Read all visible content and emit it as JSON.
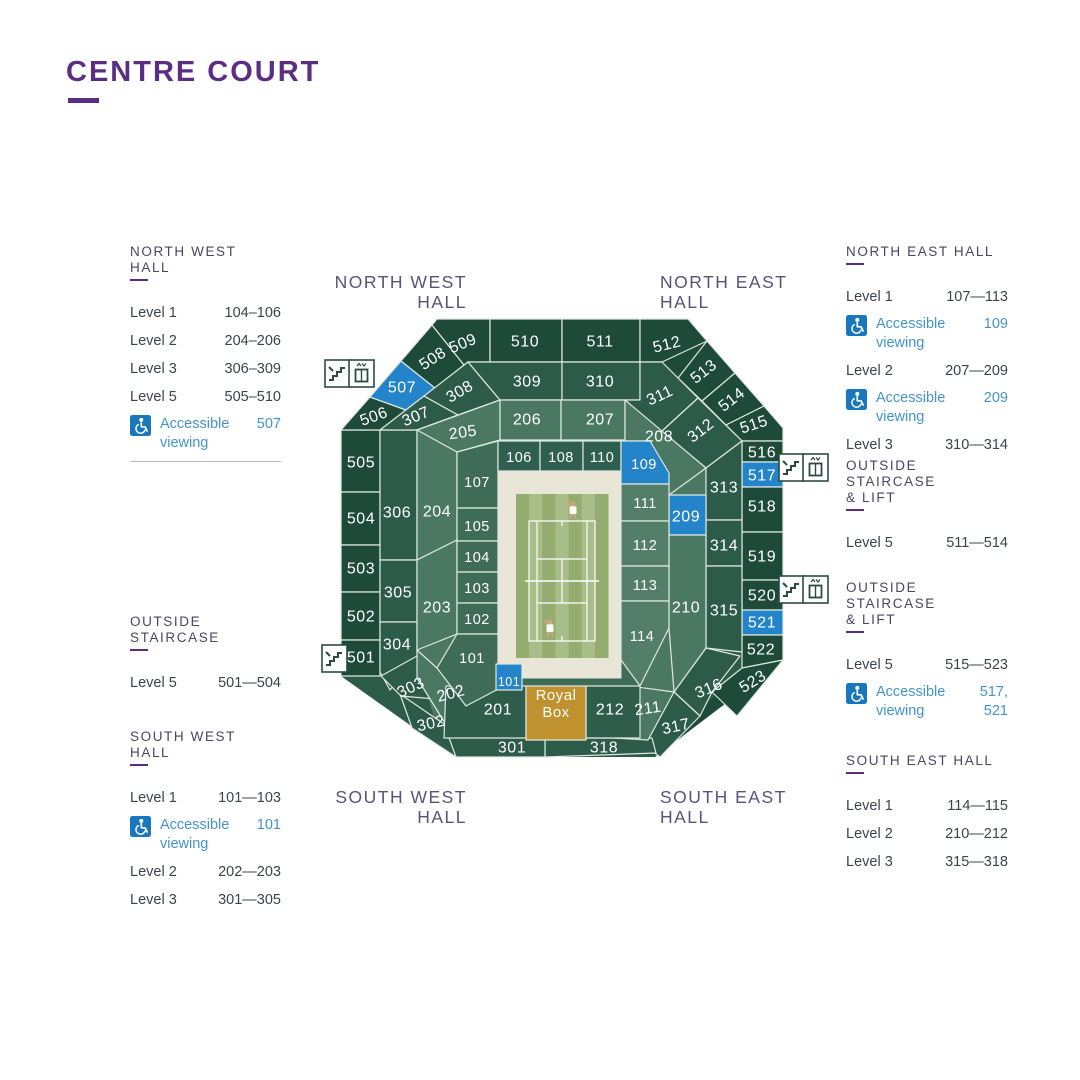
{
  "title": {
    "text": "CENTRE COURT"
  },
  "hall_labels": [
    {
      "text": "NORTH WEST\nHALL",
      "x": 267,
      "y": 273,
      "align": "right",
      "w": 200
    },
    {
      "text": "NORTH EAST\nHALL",
      "x": 660,
      "y": 273,
      "align": "left",
      "w": 200
    },
    {
      "text": "SOUTH WEST\nHALL",
      "x": 267,
      "y": 788,
      "align": "right",
      "w": 200
    },
    {
      "text": "SOUTH EAST\nHALL",
      "x": 660,
      "y": 788,
      "align": "left",
      "w": 200
    }
  ],
  "legend_left": [
    {
      "top": 244,
      "left": 130,
      "w": 151,
      "header": "NORTH WEST HALL",
      "divider": true,
      "rows": [
        {
          "label": "Level 1",
          "value": "104–106"
        },
        {
          "label": "Level 2",
          "value": "204–206"
        },
        {
          "label": "Level 3",
          "value": "306–309"
        },
        {
          "label": "Level 5",
          "value": "505–510"
        },
        {
          "label": "Accessible viewing",
          "value": "507",
          "accessible": true
        }
      ]
    },
    {
      "top": 614,
      "left": 130,
      "w": 151,
      "header": "OUTSIDE STAIRCASE",
      "rows": [
        {
          "label": "Level 5",
          "value": "501—504"
        }
      ]
    },
    {
      "top": 729,
      "left": 130,
      "w": 151,
      "header": "SOUTH WEST HALL",
      "rows": [
        {
          "label": "Level 1",
          "value": "101—103"
        },
        {
          "label": "Accessible viewing",
          "value": "101",
          "accessible": true
        },
        {
          "label": "Level 2",
          "value": "202—203"
        },
        {
          "label": "Level 3",
          "value": "301—305"
        }
      ]
    }
  ],
  "legend_right": [
    {
      "top": 244,
      "left": 846,
      "w": 162,
      "header": "NORTH EAST HALL",
      "rows": [
        {
          "label": "Level 1",
          "value": "107—113"
        },
        {
          "label": "Accessible viewing",
          "value": "109",
          "accessible": true
        },
        {
          "label": "Level 2",
          "value": "207—209"
        },
        {
          "label": "Accessible viewing",
          "value": "209",
          "accessible": true
        },
        {
          "label": "Level 3",
          "value": "310—314"
        }
      ]
    },
    {
      "top": 458,
      "left": 846,
      "w": 162,
      "header": "OUTSIDE STAIRCASE\n& LIFT",
      "rows": [
        {
          "label": "Level 5",
          "value": "511—514"
        }
      ]
    },
    {
      "top": 580,
      "left": 846,
      "w": 162,
      "header": "OUTSIDE STAIRCASE\n& LIFT",
      "rows": [
        {
          "label": "Level 5",
          "value": "515—523"
        },
        {
          "label": "Accessible viewing",
          "value": "517, 521",
          "accessible": true
        }
      ]
    },
    {
      "top": 753,
      "left": 846,
      "w": 162,
      "header": "SOUTH EAST HALL",
      "rows": [
        {
          "label": "Level 1",
          "value": "114—115"
        },
        {
          "label": "Level 2",
          "value": "210—212"
        },
        {
          "label": "Level 3",
          "value": "315—318"
        }
      ]
    }
  ],
  "map": {
    "colors": {
      "r5": "#1d4a39",
      "r3": "#2d5b49",
      "r2": "#4a7862",
      "r2d": "#2f5d4b",
      "r1w": "#3f6c59",
      "r1n": "#2e5f4f",
      "r1e": "#527e6a",
      "blue": "#2384ca",
      "gold": "#c0912f",
      "beige": "#e9e5d7",
      "grass1": "#93ad70",
      "grass2": "#a9bd89",
      "stroke": "#dfe8df",
      "icon": "#2b4d40",
      "legend_blue_icon": "#1877bd"
    },
    "silhouettes": [
      {
        "p": "437,319 688,319 783,428 783,660 655,757 455,757 341,676 341,430",
        "f": "r5"
      },
      {
        "p": "468,362 662,362 742,441 742,668 655,757 455,757 341,676 380,676 380,430",
        "f": "r3"
      },
      {
        "p": "500,400 625,400 706,468 706,648 645,738 440,738 417,660 417,430",
        "f": "r2"
      },
      {
        "p": "440,686 645,686 645,738 440,738",
        "f": "r2d"
      },
      {
        "p": "498,441 650,441 669,473 669,628 640,686 496,686 437,668 457,634 457,452",
        "f": "r1w"
      }
    ],
    "sections": [
      {
        "l": "505",
        "p": "341,430 380,430 380,492 341,492",
        "f": "r5",
        "x": 361,
        "y": 463
      },
      {
        "l": "504",
        "p": "341,492 380,492 380,545 341,545",
        "f": "r5",
        "x": 361,
        "y": 519
      },
      {
        "l": "503",
        "p": "341,545 380,545 380,592 341,592",
        "f": "r5",
        "x": 361,
        "y": 569
      },
      {
        "l": "502",
        "p": "341,592 380,592 380,640 341,640",
        "f": "r5",
        "x": 361,
        "y": 617
      },
      {
        "l": "501",
        "p": "341,640 380,640 380,676 341,676",
        "f": "r5",
        "x": 361,
        "y": 658
      },
      {
        "l": "506",
        "p": "341,430 370,397 406,410 380,430",
        "f": "r5",
        "x": 374,
        "y": 417,
        "r": -20
      },
      {
        "l": "507",
        "p": "370,397 401,361 435,388 406,410",
        "f": "blue",
        "x": 402,
        "y": 388
      },
      {
        "l": "508",
        "p": "401,361 432,325 464,365 435,388",
        "f": "r5",
        "x": 433,
        "y": 359,
        "r": -33
      },
      {
        "l": "509",
        "p": "432,325 437,319 490,319 490,362 468,362 464,365",
        "f": "r5",
        "x": 463,
        "y": 344,
        "r": -22
      },
      {
        "l": "510",
        "p": "490,319 562,319 562,362 490,362",
        "f": "r5",
        "x": 525,
        "y": 342
      },
      {
        "l": "511",
        "p": "562,319 640,319 640,362 562,362",
        "f": "r5",
        "x": 600,
        "y": 342
      },
      {
        "l": "512",
        "p": "640,319 688,319 707,341 662,362 640,362",
        "f": "r5",
        "x": 667,
        "y": 345,
        "r": -14
      },
      {
        "l": "513",
        "p": "707,341 735,373 702,401 678,378",
        "f": "r5",
        "x": 704,
        "y": 372,
        "r": -38
      },
      {
        "l": "514",
        "p": "735,373 764,406 726,425 702,401",
        "f": "r5",
        "x": 732,
        "y": 400,
        "r": -38
      },
      {
        "l": "515",
        "p": "764,406 783,428 783,441 742,441 726,425",
        "f": "r5",
        "x": 754,
        "y": 425,
        "r": -18
      },
      {
        "l": "516",
        "p": "742,441 783,441 783,462 742,462",
        "f": "r5",
        "x": 762,
        "y": 453
      },
      {
        "l": "517",
        "p": "742,462 783,462 783,487 742,487",
        "f": "blue",
        "x": 762,
        "y": 476
      },
      {
        "l": "518",
        "p": "742,487 783,487 783,532 742,532",
        "f": "r5",
        "x": 762,
        "y": 507
      },
      {
        "l": "519",
        "p": "742,532 783,532 783,580 742,580",
        "f": "r5",
        "x": 762,
        "y": 557
      },
      {
        "l": "520",
        "p": "742,580 783,580 783,610 742,610",
        "f": "r5",
        "x": 762,
        "y": 596
      },
      {
        "l": "521",
        "p": "742,610 783,610 783,635 742,635",
        "f": "blue",
        "x": 762,
        "y": 623
      },
      {
        "l": "522",
        "p": "742,635 783,635 783,660 742,668",
        "f": "r5",
        "x": 761,
        "y": 650
      },
      {
        "l": "523",
        "p": "742,668 783,660 737,716 712,692",
        "f": "r5",
        "x": 753,
        "y": 682,
        "r": -32
      },
      {
        "l": "306",
        "p": "380,430 417,430 417,560 380,560",
        "f": "r3",
        "x": 397,
        "y": 513
      },
      {
        "l": "305",
        "p": "380,560 417,560 417,622 380,622",
        "f": "r3",
        "x": 398,
        "y": 593
      },
      {
        "l": "304",
        "p": "380,622 417,622 417,658 390,690 380,672",
        "f": "r3",
        "x": 397,
        "y": 645
      },
      {
        "l": "307",
        "p": "380,430 424,396 458,415 417,430",
        "f": "r3",
        "x": 416,
        "y": 417,
        "r": -22
      },
      {
        "l": "308",
        "p": "424,396 468,362 500,400 458,415",
        "f": "r3",
        "x": 460,
        "y": 392,
        "r": -30
      },
      {
        "l": "309",
        "p": "468,362 562,362 562,400 500,400",
        "f": "r3",
        "x": 527,
        "y": 382
      },
      {
        "l": "310",
        "p": "562,362 640,362 640,400 562,400",
        "f": "r3",
        "x": 600,
        "y": 382
      },
      {
        "l": "311",
        "p": "640,362 662,362 698,398 661,432 625,400 640,400",
        "f": "r3",
        "x": 660,
        "y": 396,
        "r": -25
      },
      {
        "l": "312",
        "p": "698,398 742,441 706,468 661,432",
        "f": "r3",
        "x": 701,
        "y": 431,
        "r": -38
      },
      {
        "l": "313",
        "p": "706,468 742,441 742,520 706,520",
        "f": "r3",
        "x": 724,
        "y": 488
      },
      {
        "l": "314",
        "p": "706,520 742,520 742,566 706,566",
        "f": "r3",
        "x": 724,
        "y": 546
      },
      {
        "l": "315",
        "p": "706,566 742,566 742,652 706,648",
        "f": "r3",
        "x": 724,
        "y": 611
      },
      {
        "l": "316",
        "p": "706,648 740,656 712,692 700,716 674,692",
        "f": "r3",
        "x": 709,
        "y": 689,
        "r": -22
      },
      {
        "l": "317",
        "p": "674,692 700,716 660,757 634,737",
        "f": "r3",
        "x": 676,
        "y": 727,
        "r": -12
      },
      {
        "l": "318",
        "p": "545,738 652,738 656,753 545,757",
        "f": "r3",
        "x": 604,
        "y": 748
      },
      {
        "l": "301",
        "p": "444,728 545,738 545,757 456,757",
        "f": "r3",
        "x": 512,
        "y": 748
      },
      {
        "l": "302",
        "p": "400,694 444,724 456,757 412,728",
        "f": "r3",
        "x": 431,
        "y": 724,
        "r": -12
      },
      {
        "l": "303",
        "p": "381,676 417,656 446,700 401,696",
        "f": "r3",
        "x": 411,
        "y": 688,
        "r": -25
      },
      {
        "l": "204",
        "p": "417,430 457,444 457,540 417,560",
        "f": "r2",
        "x": 437,
        "y": 512
      },
      {
        "l": "203",
        "p": "417,560 457,540 457,634 417,650",
        "f": "r2",
        "x": 437,
        "y": 608
      },
      {
        "l": "202",
        "p": "417,650 437,668 470,700 448,728 417,678",
        "f": "r2",
        "x": 451,
        "y": 694,
        "r": -15
      },
      {
        "l": "205",
        "p": "417,430 500,400 500,440 457,452",
        "f": "r2",
        "x": 463,
        "y": 433,
        "r": -8
      },
      {
        "l": "206",
        "p": "500,400 561,400 561,440 500,440",
        "f": "r2",
        "x": 527,
        "y": 420
      },
      {
        "l": "207",
        "p": "561,400 625,400 625,440 561,440",
        "f": "r2",
        "x": 600,
        "y": 420
      },
      {
        "l": "208",
        "p": "625,400 706,468 669,495 650,441 625,441",
        "f": "r2",
        "x": 659,
        "y": 437
      },
      {
        "l": "209",
        "p": "669,495 706,495 706,535 669,535",
        "f": "blue",
        "x": 686,
        "y": 517
      },
      {
        "l": "210",
        "p": "669,535 706,535 706,648 674,692 669,628",
        "f": "r2",
        "x": 686,
        "y": 608
      },
      {
        "l": "211",
        "p": "630,686 674,692 648,740 614,738",
        "f": "r2",
        "x": 648,
        "y": 709,
        "r": -8
      },
      {
        "l": "212",
        "p": "586,686 640,686 640,738 586,738",
        "f": "r2d",
        "x": 610,
        "y": 710
      },
      {
        "l": "201",
        "p": "446,686 526,686 526,738 444,738",
        "f": "r2d",
        "x": 498,
        "y": 710
      },
      {
        "l": "Royal",
        "l2": "Box",
        "p": "526,686 586,686 586,740 526,740",
        "f": "gold",
        "x": 556,
        "y": 703,
        "s": 15
      },
      {
        "l": "107",
        "p": "457,452 498,441 498,508 457,508",
        "f": "r1w",
        "x": 477,
        "y": 483,
        "s": 14.5
      },
      {
        "l": "105",
        "p": "457,508 498,508 498,541 457,541",
        "f": "r1w",
        "x": 477,
        "y": 527,
        "s": 14.5
      },
      {
        "l": "104",
        "p": "457,541 498,541 498,572 457,572",
        "f": "r1w",
        "x": 477,
        "y": 558,
        "s": 14.5
      },
      {
        "l": "103",
        "p": "457,572 498,572 498,603 457,603",
        "f": "r1w",
        "x": 477,
        "y": 589,
        "s": 14.5
      },
      {
        "l": "102",
        "p": "457,603 498,603 498,634 457,634",
        "f": "r1w",
        "x": 477,
        "y": 620,
        "s": 14.5
      },
      {
        "l": "101",
        "p": "457,634 498,634 498,680 504,686 466,706 437,668",
        "f": "r1w",
        "x": 472,
        "y": 659,
        "s": 14.5
      },
      {
        "l": "106",
        "p": "498,441 540,441 540,471 498,471",
        "f": "r1n",
        "x": 519,
        "y": 458,
        "s": 14.5
      },
      {
        "l": "108",
        "p": "540,441 583,441 583,471 540,471",
        "f": "r1n",
        "x": 561,
        "y": 458,
        "s": 14.5
      },
      {
        "l": "110",
        "p": "583,441 621,441 621,471 583,471",
        "f": "r1n",
        "x": 602,
        "y": 458,
        "s": 14.5
      },
      {
        "l": "109",
        "p": "621,441 650,441 669,473 669,484 621,484",
        "f": "blue",
        "x": 644,
        "y": 465,
        "s": 14.5
      },
      {
        "l": "111",
        "p": "621,484 669,484 669,521 621,521",
        "f": "r1e",
        "x": 645,
        "y": 504,
        "s": 14.5
      },
      {
        "l": "112",
        "p": "621,521 669,521 669,566 621,566",
        "f": "r1e",
        "x": 645,
        "y": 546,
        "s": 14.5
      },
      {
        "l": "113",
        "p": "621,566 669,566 669,601 621,601",
        "f": "r1e",
        "x": 645,
        "y": 586,
        "s": 14.5
      },
      {
        "l": "114",
        "p": "621,601 669,601 669,628 640,686 621,660",
        "f": "r1e",
        "x": 642,
        "y": 637,
        "s": 14.5
      }
    ],
    "accessible_small": {
      "l": "101",
      "p": "496,664 522,664 522,690 496,690",
      "f": "blue",
      "x": 509,
      "y": 682,
      "s": 12.5
    },
    "court": {
      "beige": [
        498,
        471,
        123,
        207
      ],
      "grass": [
        516,
        494,
        92,
        164
      ],
      "stripes": 7,
      "lines_rect": [
        529,
        521,
        66,
        120
      ]
    },
    "players": [
      {
        "x": 573,
        "y": 504,
        "skin": "#d8a57e",
        "shirt": "#fbfaf4"
      },
      {
        "x": 550,
        "y": 622,
        "skin": "#d8a57e",
        "shirt": "#fbfaf4"
      }
    ],
    "icons": [
      {
        "type": "stairs-lift",
        "x": 325,
        "y": 360
      },
      {
        "type": "stairs",
        "x": 322,
        "y": 645
      },
      {
        "type": "stairs-lift",
        "x": 779,
        "y": 454
      },
      {
        "type": "stairs-lift",
        "x": 779,
        "y": 576
      }
    ]
  }
}
